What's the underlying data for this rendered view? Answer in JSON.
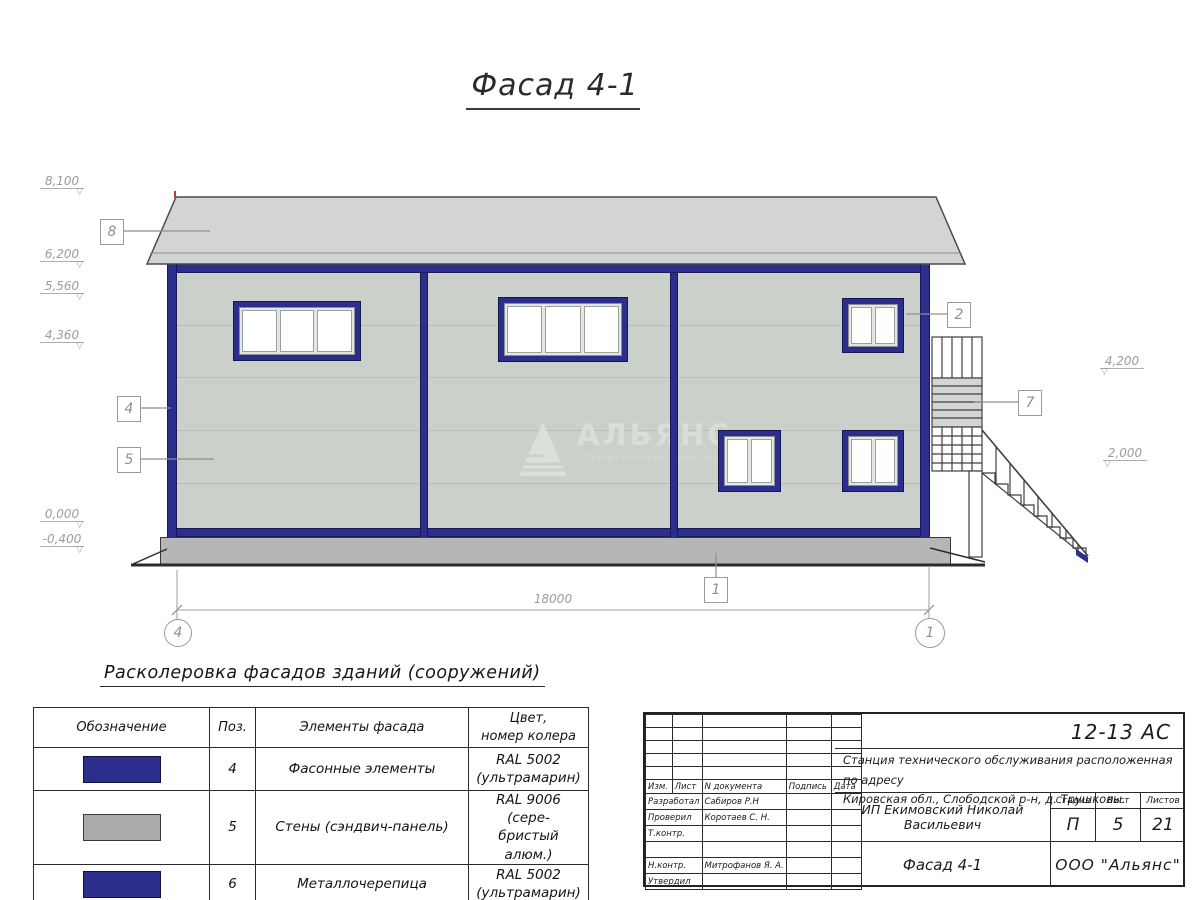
{
  "sheet": {
    "title": "Фасад 4-1"
  },
  "facade": {
    "dimension": "18000",
    "flag": "▽",
    "axes": {
      "left": "4",
      "right": "1"
    },
    "levels_left": [
      {
        "value": "8,100"
      },
      {
        "value": "6,200"
      },
      {
        "value": "5,560"
      },
      {
        "value": "4,360"
      },
      {
        "value": "0,000"
      },
      {
        "value": "-0,400"
      }
    ],
    "levels_right": [
      {
        "value": "4,200"
      },
      {
        "value": "2,000"
      }
    ],
    "callouts": {
      "roof": "8",
      "wall_corner": "4",
      "wall_panel": "5",
      "window": "2",
      "stair": "7",
      "plinth": "1"
    },
    "watermark": {
      "name": "АЛЬЯНС",
      "subtitle": "строительная компания"
    }
  },
  "colors": {
    "ultramarine": "#2b2e8c",
    "silver": "#a9abaa",
    "wall": "#cbd1ca",
    "roof": "#d2d5d4",
    "plinth": "#b4b7b6"
  },
  "color_table": {
    "title": "Расколеровка фасадов зданий (сооружений)",
    "headers": {
      "designation": "Обозначение",
      "pos": "Поз.",
      "element": "Элементы фасада",
      "color_line1": "Цвет,",
      "color_line2": "номер колера"
    },
    "rows": [
      {
        "pos": "4",
        "element": "Фасонные элементы",
        "color_line1": "RAL 5002",
        "color_line2": "(ультрамарин)",
        "swatch": "#2b2e8c"
      },
      {
        "pos": "5",
        "element": "Стены (сэндвич-панель)",
        "color_line1": "RAL 9006 (сере-",
        "color_line2": "бристый алюм.)",
        "swatch": "#a9abaa"
      },
      {
        "pos": "6",
        "element": "Металлочерепица",
        "color_line1": "RAL 5002",
        "color_line2": "(ультрамарин)",
        "swatch": "#2b2e8c"
      }
    ]
  },
  "title_block": {
    "code": "12-13 АС",
    "object_line1": "Станция технического обслуживания расположенная по адресу",
    "object_line2": "Кировская обл., Слободской р-н, д. Трушковы.",
    "client": "ИП Екимовский Николай Васильевич",
    "sheet_title": "Фасад 4-1",
    "company": "ООО \"Альянс\"",
    "stage": {
      "label": "Стадия",
      "value": "П"
    },
    "sheet_no": {
      "label": "Лист",
      "value": "5"
    },
    "sheets_total": {
      "label": "Листов",
      "value": "21"
    },
    "columns": {
      "izm": "Изм.",
      "list": "Лист",
      "ndoc": "N документа",
      "podpis": "Подпись",
      "data": "Дата"
    },
    "sig_rows": [
      {
        "label": "Разработал",
        "name": "Сабиров Р.Н"
      },
      {
        "label": "Проверил",
        "name": "Коротаев С. Н."
      },
      {
        "label": "Т.контр.",
        "name": ""
      },
      {
        "label": "",
        "name": ""
      },
      {
        "label": "Н.контр.",
        "name": "Митрофанов Я. А."
      },
      {
        "label": "Утвердил",
        "name": ""
      }
    ]
  }
}
